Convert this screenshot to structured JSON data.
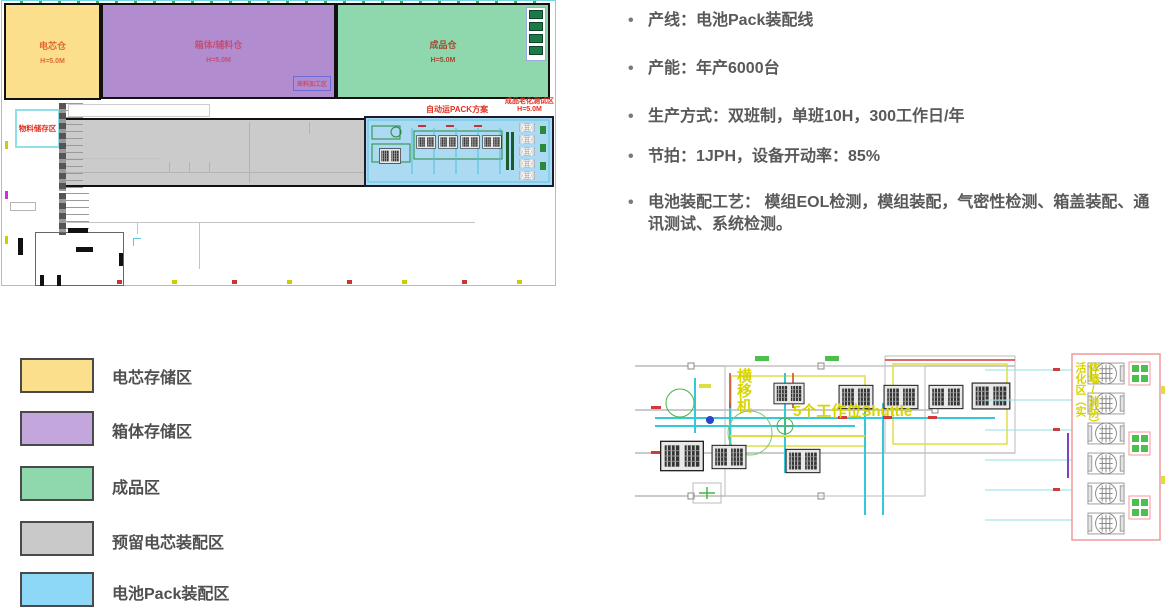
{
  "floor_plan": {
    "cell_zone": {
      "label": "电芯仓",
      "height": "H=5.0M",
      "color": "#FBDF8C",
      "text_color": "#E06A35"
    },
    "box_zone": {
      "label": "箱体/辅料仓",
      "height": "H=5.0M",
      "color": "#B18CCE",
      "text_color": "#C2507A"
    },
    "finished_zone": {
      "label": "成品仓",
      "height": "H=5.0M",
      "color": "#8FD8AD",
      "text_color": "#A04A32"
    },
    "incoming_area_label": "来料加工区",
    "material_storage_label": "物料储存区",
    "agv_plan_label": "自动运PACK方案",
    "aging_area": {
      "label": "成品老化测试区",
      "height": "H=5.0M"
    },
    "reserved_zone_color": "#CBCBCB",
    "pack_zone_color": "#ABDAF2"
  },
  "specs": {
    "bullet": "•",
    "bullets": [
      "产线：电池Pack装配线",
      "产能：年产6000台",
      "生产方式：双班制，单班10H，300工作日/年",
      "节拍：1JPH，设备开动率：85%",
      "电池装配工艺： 模组EOL检测，模组装配，气密性检测、箱盖装配、通讯测试、系统检测。"
    ]
  },
  "legend": {
    "items": [
      {
        "label": "电芯存储区",
        "color": "#FBDF8C"
      },
      {
        "label": "箱体存储区",
        "color": "#C3A6DB"
      },
      {
        "label": "成品区",
        "color": "#8FD8AD"
      },
      {
        "label": "预留电芯装配区",
        "color": "#C9C9C9"
      },
      {
        "label": "电池Pack装配区",
        "color": "#8DD7F7"
      }
    ]
  },
  "detail_drawing": {
    "transfer_machine_label": "横移机",
    "shuttle_label": "5个工作位Shuttle",
    "activation_area_label": "活化区（实体墙/消防）"
  }
}
